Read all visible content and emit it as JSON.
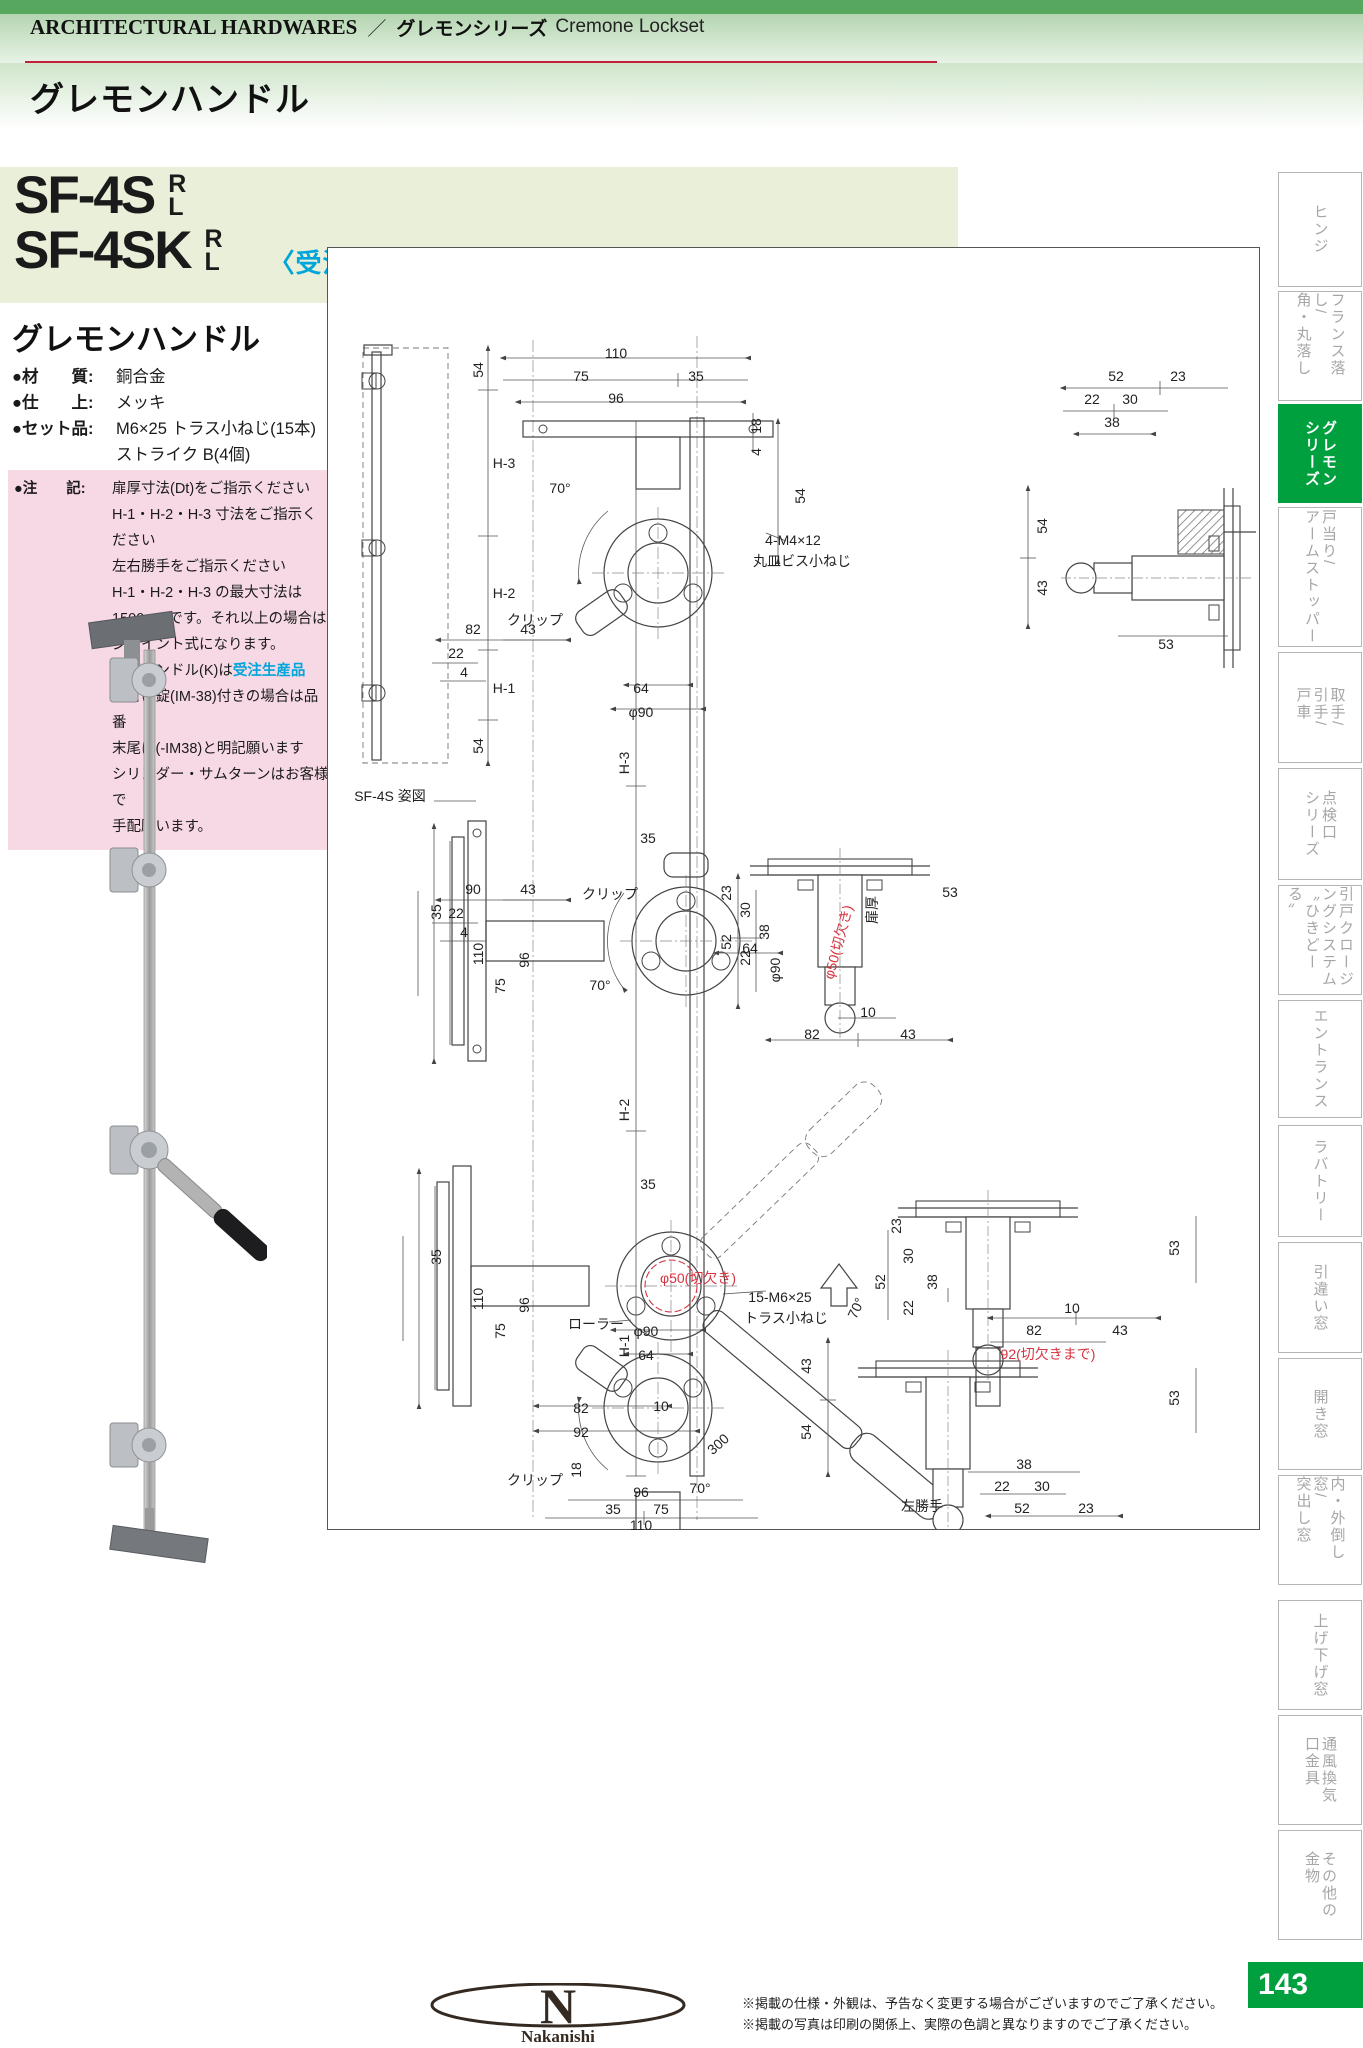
{
  "header": {
    "en": "ARCHITECTURAL HARDWARES",
    "sep": "／",
    "jp": "グレモンシリーズ",
    "en2": "Cremone Lockset",
    "page_title": "グレモンハンドル"
  },
  "product": {
    "model1": "SF-4S",
    "model2": "SF-4SK",
    "r": "R",
    "l": "L",
    "order_note": "〈受注生産品〉"
  },
  "section": {
    "title": "グレモンハンドル",
    "specs": [
      {
        "k": "●材　　質:",
        "v": "銅合金"
      },
      {
        "k": "●仕　　上:",
        "v": "メッキ"
      },
      {
        "k": "●セット品:",
        "v": "M6×25 トラス小ねじ(15本)"
      },
      {
        "k": "",
        "v": "ストライク B(4個)"
      }
    ],
    "note_key": "●注　　記:",
    "note_lines": [
      {
        "t": "扉厚寸法(Dt)をご指示ください"
      },
      {
        "t": "H-1・H-2・H-3 寸法をご指示ください"
      },
      {
        "t": "左右勝手をご指示ください"
      },
      {
        "t": "H-1・H-2・H-3 の最大寸法は"
      },
      {
        "t": "1500mmです。それ以上の場合は"
      },
      {
        "t": "ジョイント式になります。"
      },
      {
        "t": "片面ハンドル(K)は",
        "blue": "受注生産品"
      },
      {
        "t": "面付け錠(IM-38)付きの場合は品番"
      },
      {
        "t": "末尾に(-IM38)と明記願います"
      },
      {
        "t": "シリンダー・サムターンはお客様で"
      },
      {
        "t": "手配願います。"
      }
    ]
  },
  "drawing": {
    "caption": "SF-4S 姿図",
    "hand_note": "左勝手",
    "labels": [
      {
        "t": "54",
        "x": 150,
        "y": 122,
        "r": -90
      },
      {
        "t": "H-3",
        "x": 176,
        "y": 215
      },
      {
        "t": "H-2",
        "x": 176,
        "y": 345
      },
      {
        "t": "H-1",
        "x": 176,
        "y": 440
      },
      {
        "t": "54",
        "x": 150,
        "y": 498,
        "r": -90
      },
      {
        "t": "SF-4S 姿図",
        "x": 62,
        "y": 548
      },
      {
        "t": "110",
        "x": 288,
        "y": 105
      },
      {
        "t": "75",
        "x": 253,
        "y": 128
      },
      {
        "t": "35",
        "x": 368,
        "y": 128
      },
      {
        "t": "96",
        "x": 288,
        "y": 150
      },
      {
        "t": "18",
        "x": 428,
        "y": 178,
        "r": -90
      },
      {
        "t": "4",
        "x": 428,
        "y": 204,
        "r": -90
      },
      {
        "t": "54",
        "x": 472,
        "y": 248,
        "r": -90
      },
      {
        "t": "70°",
        "x": 232,
        "y": 240
      },
      {
        "t": "4-M4×12",
        "x": 465,
        "y": 292
      },
      {
        "t": "丸皿ビス小ねじ",
        "x": 474,
        "y": 313
      },
      {
        "t": "クリップ",
        "x": 207,
        "y": 372
      },
      {
        "t": "64",
        "x": 313,
        "y": 440
      },
      {
        "t": "φ90",
        "x": 313,
        "y": 464
      },
      {
        "t": "H-3",
        "x": 296,
        "y": 515,
        "r": -90
      },
      {
        "t": "H-2",
        "x": 296,
        "y": 862,
        "r": -90
      },
      {
        "t": "H-1",
        "x": 296,
        "y": 1098,
        "r": -90
      },
      {
        "t": "82",
        "x": 145,
        "y": 381
      },
      {
        "t": "43",
        "x": 200,
        "y": 381
      },
      {
        "t": "22",
        "x": 128,
        "y": 405
      },
      {
        "t": "4",
        "x": 136,
        "y": 424
      },
      {
        "t": "35",
        "x": 320,
        "y": 590
      },
      {
        "t": "クリップ",
        "x": 282,
        "y": 646
      },
      {
        "t": "35",
        "x": 108,
        "y": 664,
        "r": -90
      },
      {
        "t": "110",
        "x": 150,
        "y": 706,
        "r": -90
      },
      {
        "t": "96",
        "x": 196,
        "y": 712,
        "r": -90
      },
      {
        "t": "75",
        "x": 172,
        "y": 738,
        "r": -90
      },
      {
        "t": "70°",
        "x": 272,
        "y": 737
      },
      {
        "t": "64",
        "x": 422,
        "y": 700
      },
      {
        "t": "φ90",
        "x": 447,
        "y": 722,
        "r": -90
      },
      {
        "t": "90",
        "x": 145,
        "y": 641
      },
      {
        "t": "43",
        "x": 200,
        "y": 641
      },
      {
        "t": "22",
        "x": 128,
        "y": 665
      },
      {
        "t": "4",
        "x": 136,
        "y": 684
      },
      {
        "t": "35",
        "x": 320,
        "y": 936
      },
      {
        "t": "φ50(切欠き)",
        "x": 370,
        "y": 1030,
        "c": "red"
      },
      {
        "t": "15-M6×25",
        "x": 452,
        "y": 1049
      },
      {
        "t": "トラス小ねじ",
        "x": 458,
        "y": 1070
      },
      {
        "t": "ローラー",
        "x": 268,
        "y": 1076
      },
      {
        "t": "70°",
        "x": 528,
        "y": 1060,
        "r": -65
      },
      {
        "t": "35",
        "x": 108,
        "y": 1009,
        "r": -90
      },
      {
        "t": "110",
        "x": 150,
        "y": 1051,
        "r": -90
      },
      {
        "t": "96",
        "x": 196,
        "y": 1057,
        "r": -90
      },
      {
        "t": "75",
        "x": 172,
        "y": 1083,
        "r": -90
      },
      {
        "t": "82",
        "x": 253,
        "y": 1160
      },
      {
        "t": "10",
        "x": 333,
        "y": 1158
      },
      {
        "t": "92",
        "x": 253,
        "y": 1184
      },
      {
        "t": "300",
        "x": 390,
        "y": 1196,
        "r": -42
      },
      {
        "t": "φ90",
        "x": 318,
        "y": 1083
      },
      {
        "t": "64",
        "x": 318,
        "y": 1107
      },
      {
        "t": "クリップ",
        "x": 207,
        "y": 1232
      },
      {
        "t": "70°",
        "x": 372,
        "y": 1240
      },
      {
        "t": "18",
        "x": 248,
        "y": 1222,
        "r": -90
      },
      {
        "t": "96",
        "x": 313,
        "y": 1244
      },
      {
        "t": "35",
        "x": 285,
        "y": 1261
      },
      {
        "t": "75",
        "x": 333,
        "y": 1261
      },
      {
        "t": "110",
        "x": 313,
        "y": 1277
      },
      {
        "t": "52",
        "x": 788,
        "y": 128
      },
      {
        "t": "23",
        "x": 850,
        "y": 128
      },
      {
        "t": "22",
        "x": 764,
        "y": 151
      },
      {
        "t": "30",
        "x": 802,
        "y": 151
      },
      {
        "t": "38",
        "x": 784,
        "y": 174
      },
      {
        "t": "54",
        "x": 714,
        "y": 278,
        "r": -90
      },
      {
        "t": "43",
        "x": 714,
        "y": 340,
        "r": -90
      },
      {
        "t": "53",
        "x": 838,
        "y": 396
      },
      {
        "t": "23",
        "x": 398,
        "y": 645,
        "r": -90
      },
      {
        "t": "52",
        "x": 398,
        "y": 694,
        "r": -90
      },
      {
        "t": "30",
        "x": 417,
        "y": 662,
        "r": -90
      },
      {
        "t": "22",
        "x": 417,
        "y": 710,
        "r": -90
      },
      {
        "t": "38",
        "x": 436,
        "y": 684,
        "r": -90
      },
      {
        "t": "φ50(切欠き)",
        "x": 510,
        "y": 694,
        "r": -75,
        "c": "red"
      },
      {
        "t": "扉厚",
        "x": 544,
        "y": 662,
        "r": -90
      },
      {
        "t": "53",
        "x": 622,
        "y": 644
      },
      {
        "t": "10",
        "x": 540,
        "y": 764
      },
      {
        "t": "82",
        "x": 484,
        "y": 786
      },
      {
        "t": "43",
        "x": 580,
        "y": 786
      },
      {
        "t": "23",
        "x": 568,
        "y": 978,
        "r": -90
      },
      {
        "t": "52",
        "x": 552,
        "y": 1034,
        "r": -90
      },
      {
        "t": "30",
        "x": 580,
        "y": 1008,
        "r": -90
      },
      {
        "t": "22",
        "x": 580,
        "y": 1060,
        "r": -90
      },
      {
        "t": "38",
        "x": 604,
        "y": 1034,
        "r": -90
      },
      {
        "t": "53",
        "x": 846,
        "y": 1000,
        "r": -90
      },
      {
        "t": "10",
        "x": 744,
        "y": 1060
      },
      {
        "t": "82",
        "x": 706,
        "y": 1082
      },
      {
        "t": "43",
        "x": 792,
        "y": 1082
      },
      {
        "t": "92(切欠きまで)",
        "x": 720,
        "y": 1106,
        "c": "red"
      },
      {
        "t": "43",
        "x": 478,
        "y": 1118,
        "r": -90
      },
      {
        "t": "54",
        "x": 478,
        "y": 1184,
        "r": -90
      },
      {
        "t": "53",
        "x": 846,
        "y": 1150,
        "r": -90
      },
      {
        "t": "38",
        "x": 696,
        "y": 1216
      },
      {
        "t": "22",
        "x": 674,
        "y": 1238
      },
      {
        "t": "30",
        "x": 714,
        "y": 1238
      },
      {
        "t": "52",
        "x": 694,
        "y": 1260
      },
      {
        "t": "23",
        "x": 758,
        "y": 1260
      },
      {
        "t": "左勝手",
        "x": 594,
        "y": 1258
      }
    ]
  },
  "sidebar": {
    "tabs": [
      {
        "lines": [
          "ヒンジ"
        ],
        "active": false
      },
      {
        "lines": [
          "フランス落し/",
          "角・丸落し"
        ],
        "active": false
      },
      {
        "lines": [
          "グレモン",
          "シリーズ"
        ],
        "active": true
      },
      {
        "lines": [
          "戸当り/",
          "アームストッパー"
        ],
        "active": false
      },
      {
        "lines": [
          "取手/",
          "引手/",
          "戸車"
        ],
        "active": false
      },
      {
        "lines": [
          "点検口",
          "シリーズ"
        ],
        "active": false
      },
      {
        "lines": [
          "引戸クロージ",
          "ングシステム",
          "〝ひきどーる〟"
        ],
        "active": false
      },
      {
        "lines": [
          "エントランス"
        ],
        "active": false
      },
      {
        "lines": [
          "ラバトリー"
        ],
        "active": false
      },
      {
        "lines": [
          "引違い窓"
        ],
        "active": false
      },
      {
        "lines": [
          "開き窓"
        ],
        "active": false
      },
      {
        "lines": [
          "内・外倒し窓/",
          "突出し窓"
        ],
        "active": false
      },
      {
        "lines": [
          "上げ下げ窓"
        ],
        "active": false
      },
      {
        "lines": [
          "通風換気",
          "口金具"
        ],
        "active": false
      },
      {
        "lines": [
          "その他の",
          "金物"
        ],
        "active": false
      }
    ],
    "page_number": "143"
  },
  "footer": {
    "logo_letter": "N",
    "logo_name": "Nakanishi",
    "notes": [
      "※掲載の仕様・外観は、予告なく変更する場合がございますのでご了承ください。",
      "※掲載の写真は印刷の関係上、実際の色調と異なりますのでご了承ください。"
    ]
  },
  "colors": {
    "accent_green": "#00a03e",
    "band_green": "#b4d5b0",
    "pale_green": "#e9efd8",
    "pink": "#f7d9e5",
    "blue": "#00a5da",
    "red": "#d7333f",
    "rule_red": "#c31f3b"
  }
}
